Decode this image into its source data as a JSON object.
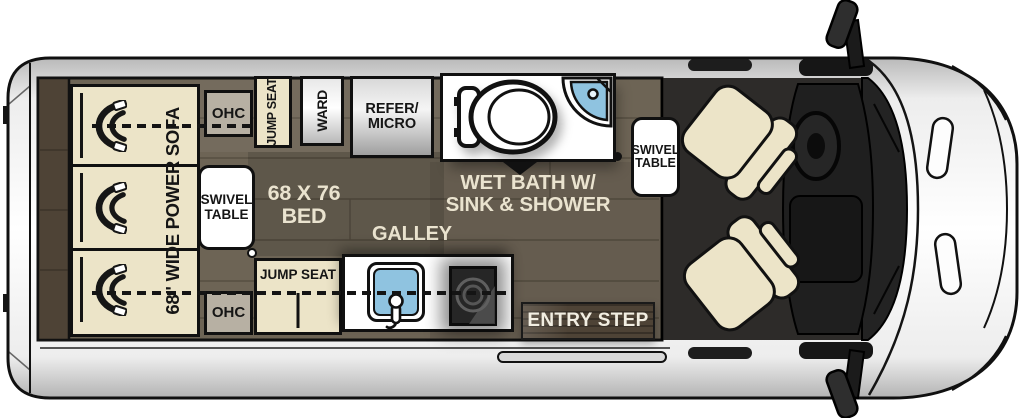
{
  "colors": {
    "body_outline": "#101010",
    "floor_wood": "#6d6455",
    "floor_wood_dark": "#4e4336",
    "seat_cream": "#ece4c8",
    "cabinet_gray": "#b7b0a3",
    "sink_blue": "#8fc3e0",
    "cab_floor": "#2d2b29",
    "label_cream": "#eae3cf"
  },
  "floorplan": {
    "sofa_label": "68\" WIDE POWER SOFA",
    "ohc_top": "OHC",
    "ohc_bottom": "OHC",
    "swivel_table_left": {
      "line1": "SWIVEL",
      "line2": "TABLE"
    },
    "swivel_table_right": {
      "line1": "SWIVEL",
      "line2": "TABLE"
    },
    "jump_seat_top": "JUMP SEAT",
    "ward": "WARD",
    "refer_micro": {
      "line1": "REFER/",
      "line2": "MICRO"
    },
    "wet_bath": {
      "line1": "WET BATH W/",
      "line2": "SINK & SHOWER"
    },
    "bed": {
      "line1": "68 X 76",
      "line2": "BED"
    },
    "galley": "GALLEY",
    "jump_seat_bottom": "JUMP SEAT",
    "entry_step": "ENTRY STEP"
  }
}
